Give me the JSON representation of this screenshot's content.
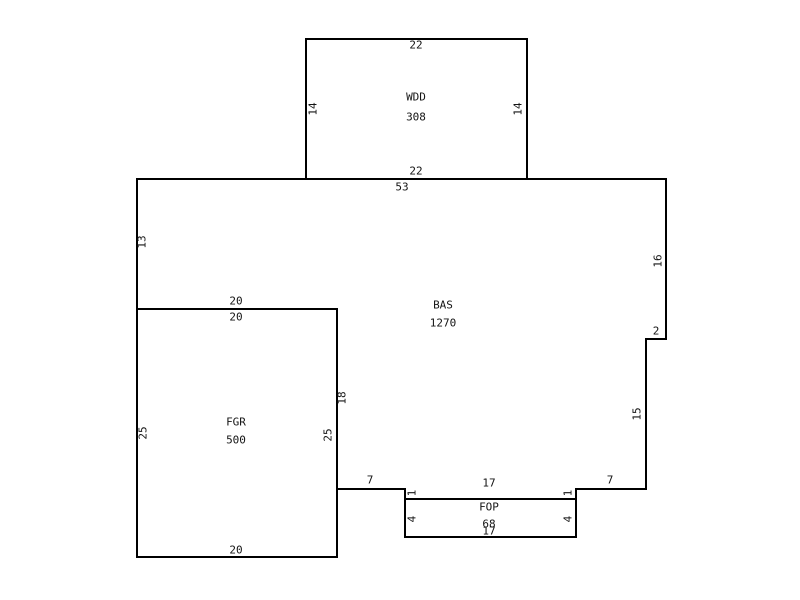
{
  "canvas": {
    "background": "#ffffff",
    "stroke_color": "#000000",
    "text_color": "#141414"
  },
  "rooms": [
    {
      "code": "WDD",
      "area": "308",
      "polygon": [
        [
          306,
          39
        ],
        [
          527,
          39
        ],
        [
          527,
          179
        ],
        [
          306,
          179
        ]
      ],
      "code_pos": [
        416,
        97
      ],
      "area_pos": [
        416,
        117
      ]
    },
    {
      "code": "BAS",
      "area": "1270",
      "polygon": [
        [
          137,
          179
        ],
        [
          666,
          179
        ],
        [
          666,
          339
        ],
        [
          646,
          339
        ],
        [
          646,
          489
        ],
        [
          576,
          489
        ],
        [
          576,
          499
        ],
        [
          405,
          499
        ],
        [
          405,
          489
        ],
        [
          337,
          489
        ],
        [
          337,
          309
        ],
        [
          137,
          309
        ]
      ],
      "code_pos": [
        443,
        305
      ],
      "area_pos": [
        443,
        323
      ]
    },
    {
      "code": "FGR",
      "area": "500",
      "polygon": [
        [
          137,
          309
        ],
        [
          337,
          309
        ],
        [
          337,
          557
        ],
        [
          137,
          557
        ]
      ],
      "code_pos": [
        236,
        422
      ],
      "area_pos": [
        236,
        440
      ]
    },
    {
      "code": "FOP",
      "area": "68",
      "polygon": [
        [
          405,
          499
        ],
        [
          576,
          499
        ],
        [
          576,
          537
        ],
        [
          405,
          537
        ]
      ],
      "code_pos": [
        489,
        507
      ],
      "area_pos": [
        489,
        524
      ]
    }
  ],
  "dimension_labels": [
    {
      "text": "22",
      "x": 416,
      "y": 45,
      "rot": 0
    },
    {
      "text": "14",
      "x": 313,
      "y": 109,
      "rot": -90
    },
    {
      "text": "14",
      "x": 518,
      "y": 109,
      "rot": -90
    },
    {
      "text": "22",
      "x": 416,
      "y": 171,
      "rot": 0
    },
    {
      "text": "53",
      "x": 402,
      "y": 187,
      "rot": 0
    },
    {
      "text": "13",
      "x": 142,
      "y": 242,
      "rot": -90
    },
    {
      "text": "16",
      "x": 658,
      "y": 261,
      "rot": -90
    },
    {
      "text": "2",
      "x": 656,
      "y": 331,
      "rot": 0
    },
    {
      "text": "15",
      "x": 637,
      "y": 414,
      "rot": -90
    },
    {
      "text": "20",
      "x": 236,
      "y": 301,
      "rot": 0
    },
    {
      "text": "20",
      "x": 236,
      "y": 317,
      "rot": 0
    },
    {
      "text": "18",
      "x": 342,
      "y": 398,
      "rot": -90
    },
    {
      "text": "25",
      "x": 143,
      "y": 433,
      "rot": -90
    },
    {
      "text": "25",
      "x": 328,
      "y": 435,
      "rot": -90
    },
    {
      "text": "20",
      "x": 236,
      "y": 550,
      "rot": 0
    },
    {
      "text": "7",
      "x": 370,
      "y": 480,
      "rot": 0
    },
    {
      "text": "7",
      "x": 610,
      "y": 480,
      "rot": 0
    },
    {
      "text": "17",
      "x": 489,
      "y": 483,
      "rot": 0
    },
    {
      "text": "1",
      "x": 412,
      "y": 493,
      "rot": -90
    },
    {
      "text": "1",
      "x": 568,
      "y": 493,
      "rot": -90
    },
    {
      "text": "4",
      "x": 412,
      "y": 519,
      "rot": -90
    },
    {
      "text": "4",
      "x": 568,
      "y": 519,
      "rot": -90
    },
    {
      "text": "17",
      "x": 489,
      "y": 531,
      "rot": 0
    }
  ]
}
